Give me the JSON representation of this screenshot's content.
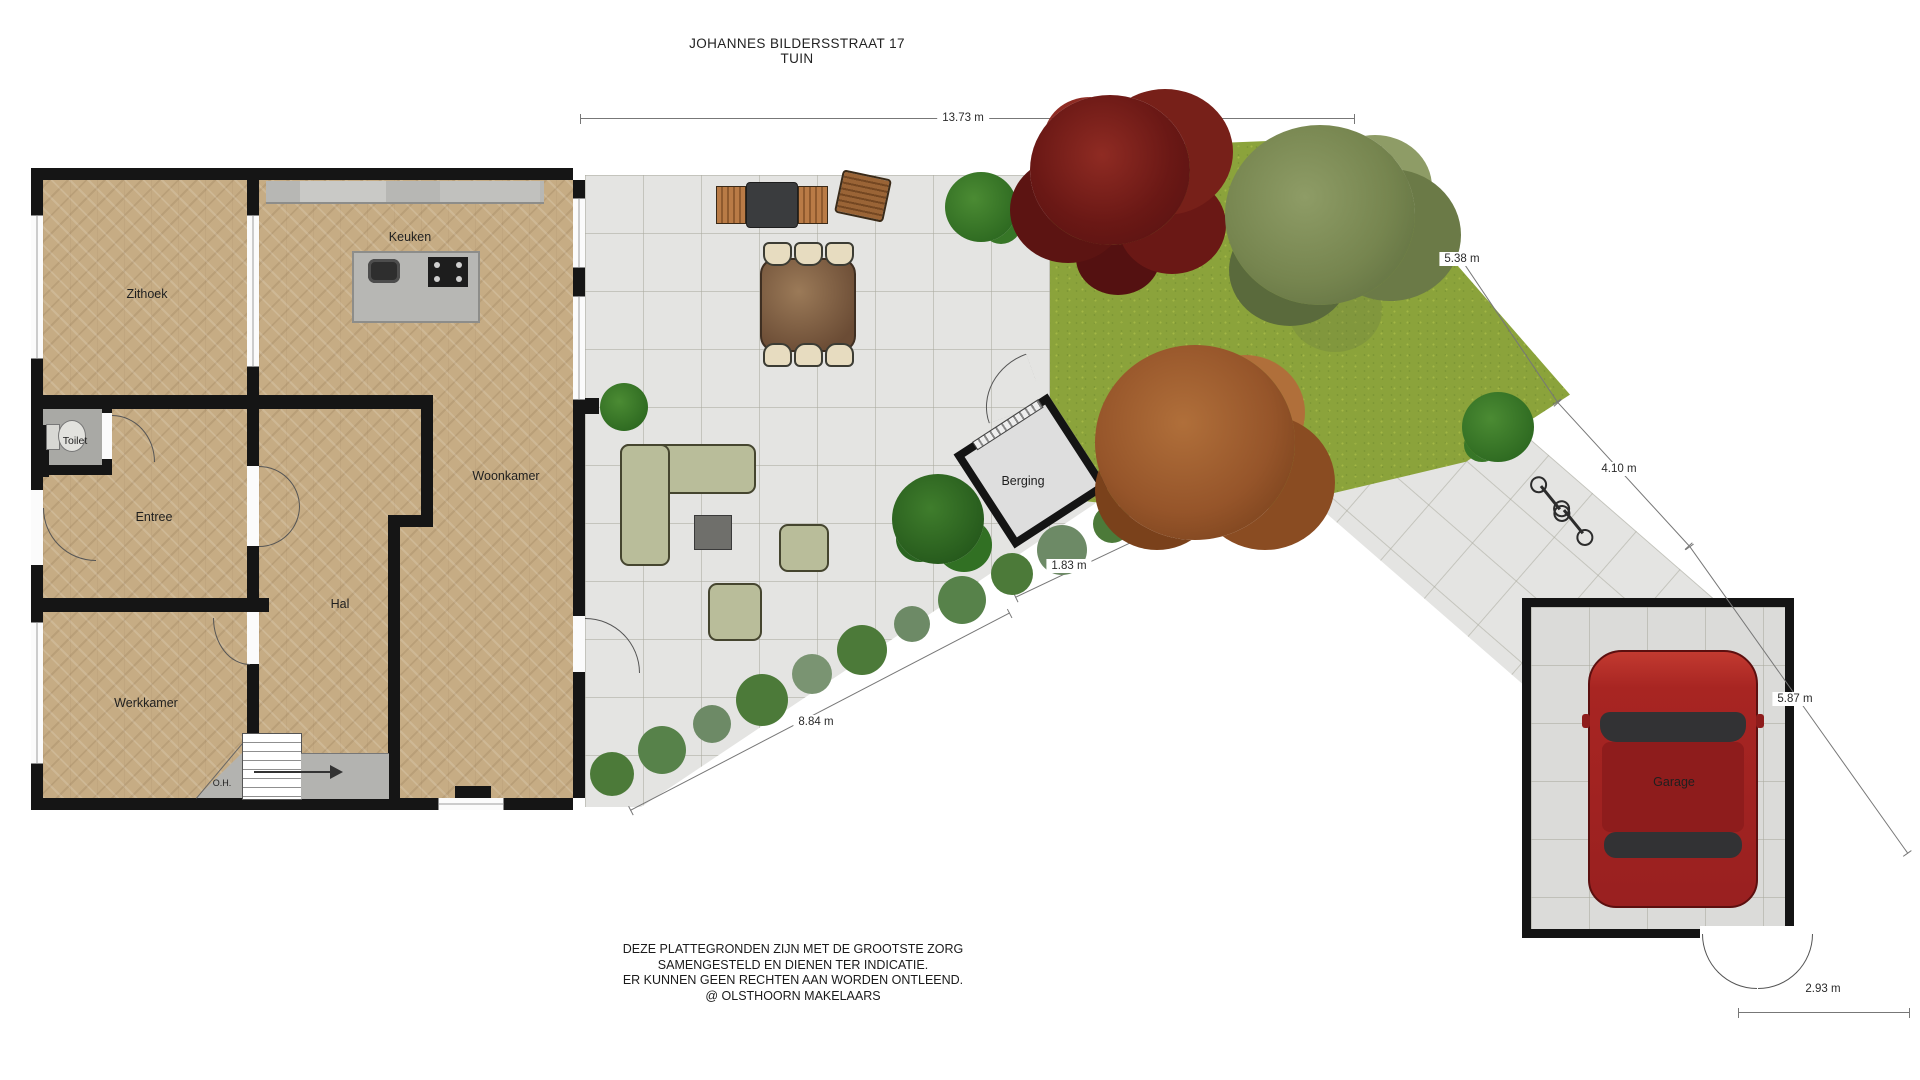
{
  "title": {
    "line1": "JOHANNES BILDERSSTRAAT 17",
    "line2": "TUIN"
  },
  "rooms": {
    "zithoek": "Zithoek",
    "keuken": "Keuken",
    "toilet": "Toilet",
    "entree": "Entree",
    "hal": "Hal",
    "werkkamer": "Werkkamer",
    "oh": "O.H.",
    "woonkamer": "Woonkamer",
    "berging": "Berging",
    "garage": "Garage"
  },
  "dimensions": {
    "top_width": "13.73 m",
    "right_upper": "5.38 m",
    "right_mid": "4.10 m",
    "right_lower": "5.87 m",
    "berging_gap": "1.83 m",
    "terrace_diagonal": "8.84 m",
    "garage_width": "2.93 m"
  },
  "disclaimer": {
    "line1": "DEZE PLATTEGRONDEN ZIJN MET DE GROOTSTE ZORG",
    "line2": "SAMENGESTELD EN DIENEN TER INDICATIE.",
    "line3": "ER KUNNEN GEEN RECHTEN AAN WORDEN ONTLEEND.",
    "line4": "@ OLSTHOORN MAKELAARS"
  },
  "colors": {
    "wall": "#151515",
    "wood_floor": "#c6ac84",
    "terrace_tile": "#e4e4e2",
    "grass": "#8ba33b",
    "hedge_green": "#4c7a39",
    "tree_red": "#6e1c19",
    "tree_olive": "#76854f",
    "tree_rust": "#96552a",
    "sofa_green": "#b9bd9a",
    "car_red": "#a32222",
    "counter_gray": "#b7b7b4"
  }
}
